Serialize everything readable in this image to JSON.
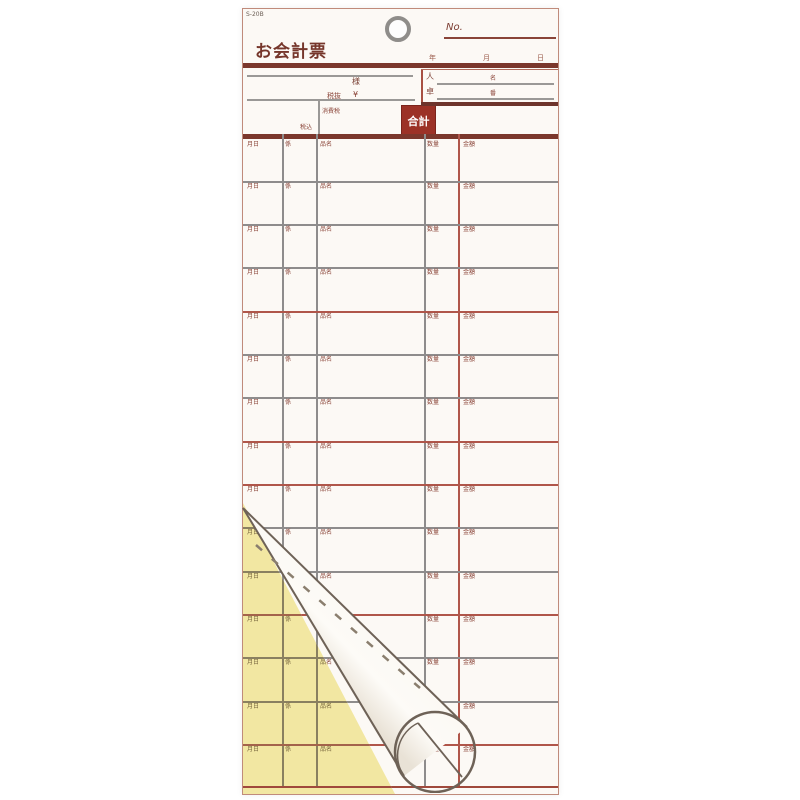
{
  "paper": {
    "product_code": "S-20B",
    "title": "お会計票",
    "header": {
      "no_label": "No.",
      "date_units": {
        "year": "年",
        "month": "月",
        "day": "日"
      },
      "name_suffix": "様",
      "tax_excluded_label": "税抜",
      "yen_sign": "¥",
      "tax_included_label": "税込",
      "consumption_tax_label": "消費税",
      "total_label": "合計",
      "guests_label": "人",
      "guests_unit": "名",
      "table_no_label": "卓",
      "table_no_unit": "番"
    },
    "table": {
      "row_labels": [
        "月日",
        "係",
        "品名",
        "数量",
        "金額"
      ],
      "row_count": 15,
      "row_tops": [
        130,
        172,
        215,
        258,
        302,
        345,
        388,
        432,
        475,
        518,
        562,
        605,
        648,
        692,
        735
      ],
      "red_separator_rows": [
        4,
        7,
        8,
        11,
        14
      ],
      "column_x": [
        39,
        73,
        181,
        215
      ],
      "red_column_index": 3
    },
    "colors": {
      "paper_white": "#fcf9f5",
      "copy_sheet_yellow": "#f2e7a2",
      "rule_dark_red": "#7b372c",
      "line_red": "#b0564a",
      "line_gray": "#8e8c8c",
      "total_box_bg": "#9c3227",
      "total_box_text": "#ffffff",
      "label_red": "#8a4438"
    }
  }
}
